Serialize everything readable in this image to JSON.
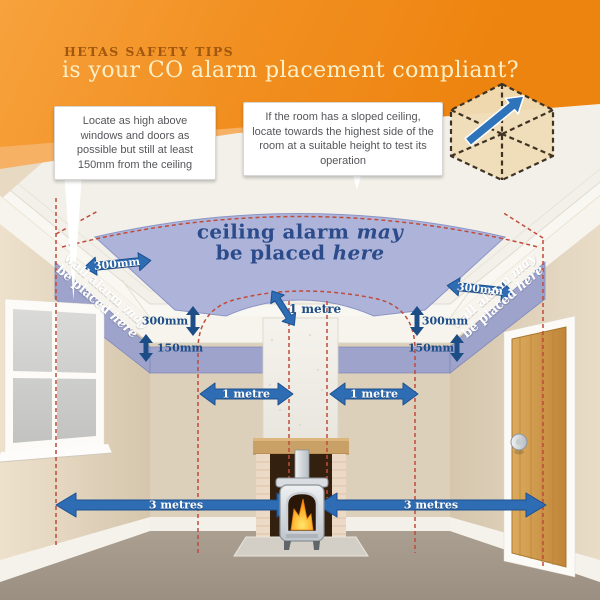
{
  "header": {
    "kicker": "HETAS SAFETY TIPS",
    "title": "is your CO alarm placement compliant?"
  },
  "callouts": {
    "left": "Locate as high above windows and doors as possible but still at least 150mm from the ceiling",
    "right": "If the room has a sloped ceiling, locate towards the highest side of the room at a suitable height to test its operation"
  },
  "zones": {
    "ceiling": {
      "line1": "ceiling alarm",
      "line1_em": "may",
      "line2": "be placed",
      "line2_em": "here"
    },
    "wall_left": {
      "line1": "wall alarm",
      "line1_em": "may",
      "line2": "be placed",
      "line2_em": "here"
    },
    "wall_right": {
      "line1": "wall alarm",
      "line1_em": "may",
      "line2": "be placed",
      "line2_em": "here"
    }
  },
  "measurements": {
    "ceiling_left": "300mm",
    "ceiling_right": "300mm",
    "wall_left_300": "300mm",
    "wall_left_150": "150mm",
    "wall_right_300": "300mm",
    "wall_right_150": "150mm",
    "flue_clearance": "1 metre",
    "appliance_left": "1 metre",
    "appliance_right": "1 metre",
    "floor_left": "3 metres",
    "floor_right": "3 metres"
  },
  "colors": {
    "brand_orange": "#EF850F",
    "zone_blue": "#AEB4D9",
    "band_blue": "#9DA3CB",
    "arrow_blue": "#2E6CB4",
    "dashed_red": "#C04B3B",
    "navy_text": "#1D4D86"
  }
}
